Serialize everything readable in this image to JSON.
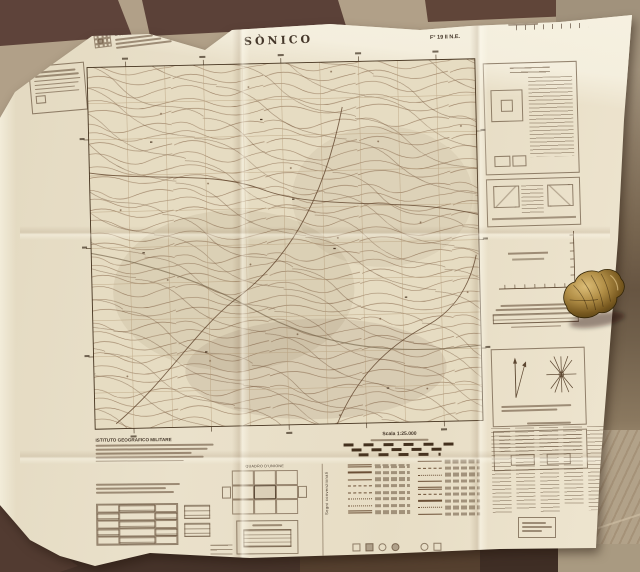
{
  "scene": {
    "type": "photograph",
    "subject": "Folded vintage Italian 1:25,000 military topographic map lying on a tiled floor, with a small brass clasp resting on its right edge",
    "colors": {
      "floor_tile_dark": "#5e433a",
      "floor_tile_light": "#b3a28a",
      "paper": "#e9dfc8",
      "map_ink": "#7a5c40",
      "brass": "#a8843e"
    }
  },
  "header": {
    "series_title": "CARTA D'ITALIA ALLA SCALA DI 1:25.000",
    "sheet_title": "SÒNICO",
    "sheet_ref": "F° 19 II N.E."
  },
  "footer": {
    "publisher": "ISTITUTO GEOGRAFICO MILITARE",
    "scale_label": "Scala 1:25.000",
    "union_diagram_label": "QUADRO D'UNIONE",
    "legend_vertical_label": "Segni convenzionali"
  }
}
